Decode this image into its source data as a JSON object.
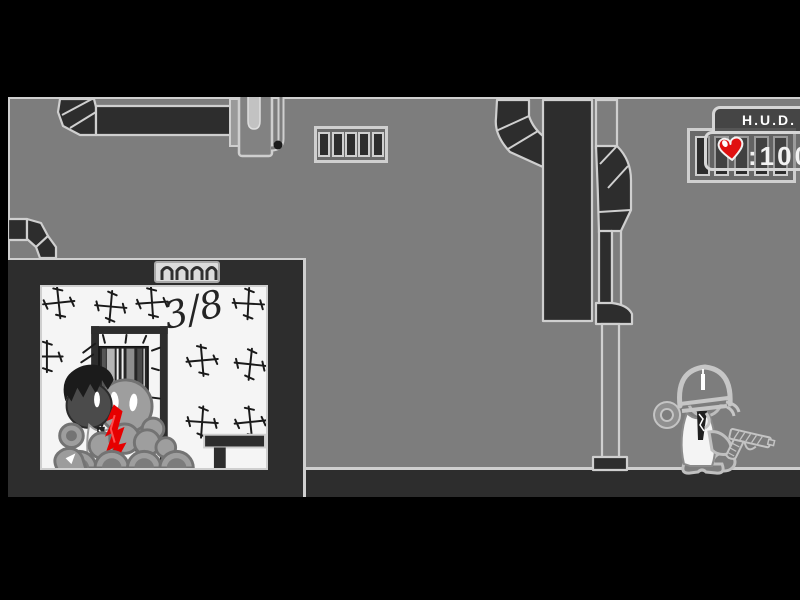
{
  "hud": {
    "title": "H.U.D.",
    "health_value": ":100",
    "health_icon": "heart-icon"
  },
  "room": {
    "progress_label": "3/8"
  },
  "colors": {
    "bg": "#000000",
    "wall": "#7d7d7d",
    "dark": "#2d2d2d",
    "outline": "#cfcfcf",
    "room": "#f5f5f5",
    "ink": "#1a1a1a",
    "blood": "#e60000",
    "heart": "#e01010",
    "hud_text": "#f2f2f2"
  }
}
